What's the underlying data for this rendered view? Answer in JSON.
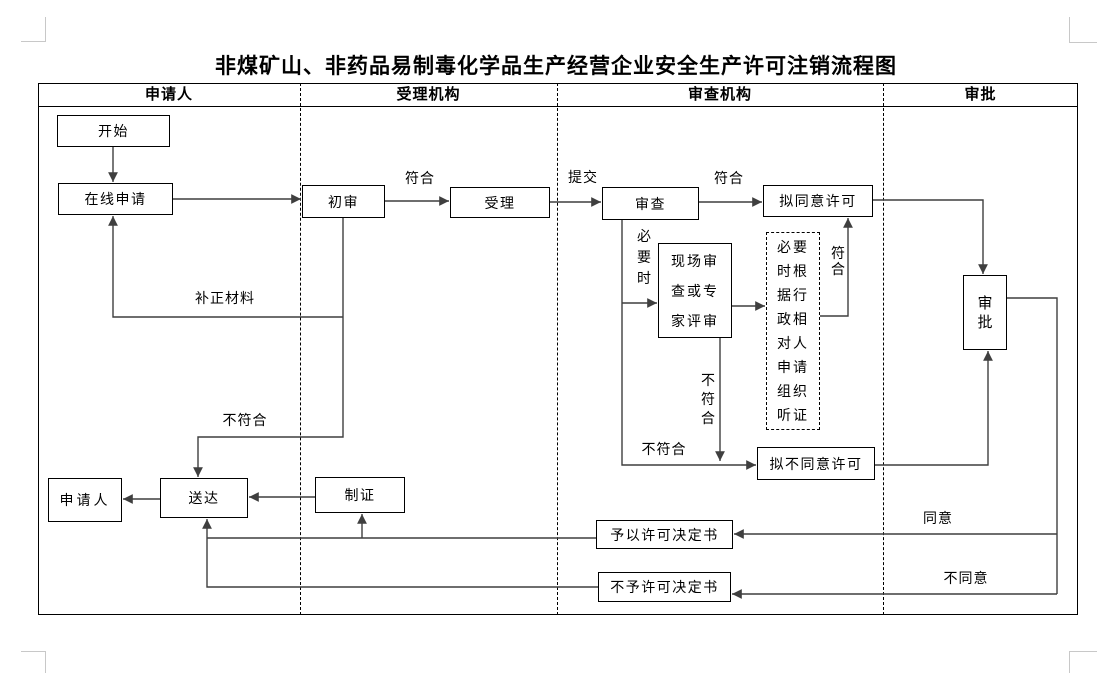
{
  "title": "非煤矿山、非药品易制毒化学品生产经营企业安全生产许可注销流程图",
  "lanes": {
    "applicant": "申请人",
    "acceptance": "受理机构",
    "review": "审查机构",
    "approval": "审批"
  },
  "nodes": {
    "start": "开始",
    "online_apply": "在线申请",
    "initial_review": "初审",
    "accept": "受理",
    "review": "审查",
    "propose_approve": "拟同意许可",
    "onsite_review": "现场审\n查或专\n家评审",
    "hearing": "必要\n时根\n据行\n政相\n对人\n申请\n组织\n听证",
    "approve": "审\n批",
    "propose_disapprove": "拟不同意许可",
    "applicant": "申请人",
    "deliver": "送达",
    "make_certificate": "制证",
    "grant_decision": "予以许可决定书",
    "deny_decision": "不予许可决定书"
  },
  "edge_labels": {
    "conform_1": "符合",
    "submit": "提交",
    "conform_2": "符合",
    "supplement_materials": "补正材料",
    "not_conform_1": "不符合",
    "when_necessary": "必\n要\n时",
    "conform_3": "符\n合",
    "not_conform_2": "不\n符\n合",
    "not_conform_3": "不符合",
    "agree": "同意",
    "disagree": "不同意"
  },
  "colors": {
    "line": "#3f3f3f",
    "border": "#000000",
    "crop_mark": "#c8c8c8"
  }
}
